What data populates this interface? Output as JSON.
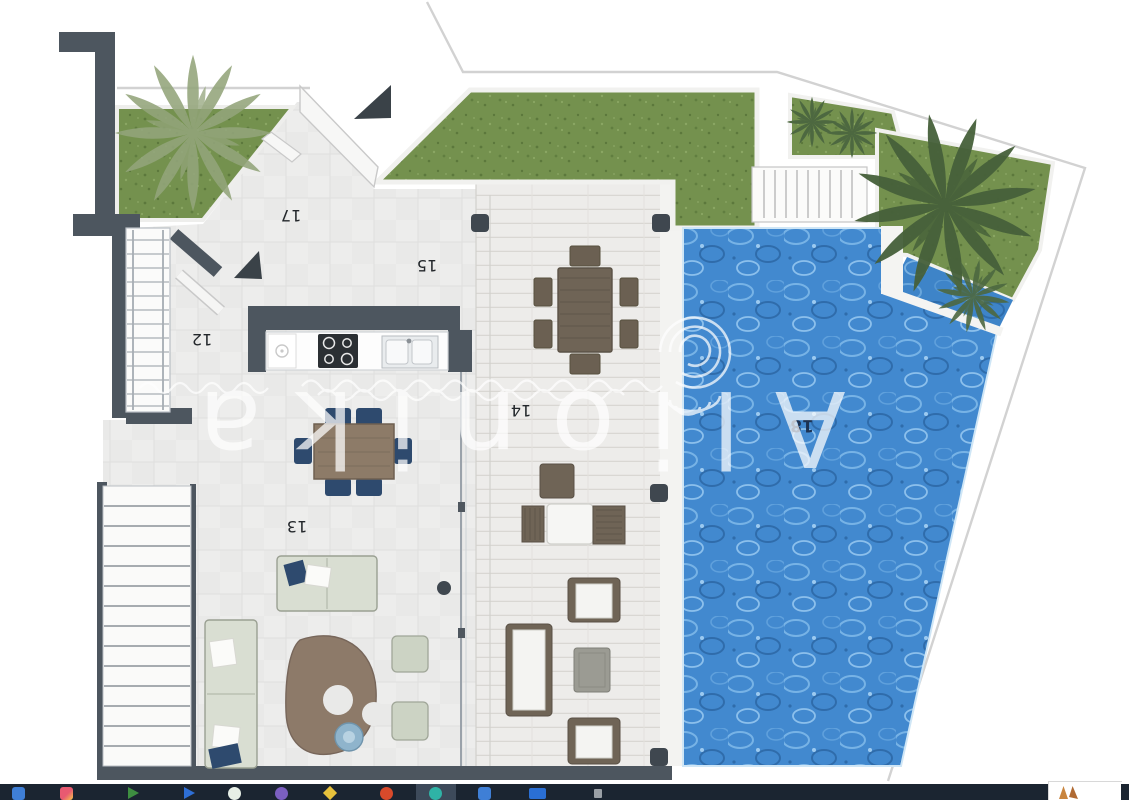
{
  "plan": {
    "labels": [
      {
        "text": "12"
      },
      {
        "text": "13"
      },
      {
        "text": "14"
      },
      {
        "text": "15"
      },
      {
        "text": "17"
      },
      {
        "text": "18"
      }
    ],
    "label_color": "#23272b",
    "pool_label_color": "#1c3354",
    "wall_color": "#4d565f",
    "grass_color": "#74914e",
    "water_color": "#4289cf"
  },
  "watermark": {
    "text": "Alionika",
    "color": "#ffffff"
  },
  "taskbar": {
    "background": "#1b2531",
    "active_highlight": "#3d4a5a",
    "icons": [
      {
        "name": "file-explorer",
        "color": "#3f7fd6",
        "shape": "rounded"
      },
      {
        "name": "photos-app",
        "color": "#e85a71",
        "color2": "#f6c94a",
        "shape": "rounded"
      },
      {
        "name": "green-play-app",
        "color": "#3e8e41",
        "shape": "triangle"
      },
      {
        "name": "blue-arrow-app",
        "color": "#2e6fd6",
        "shape": "triangle"
      },
      {
        "name": "light-circle-app",
        "color": "#e6efe6",
        "shape": "circle"
      },
      {
        "name": "purple-circle-app",
        "color": "#7b5fc0",
        "shape": "circle"
      },
      {
        "name": "yellow-app",
        "color": "#e7c23c",
        "shape": "diamond"
      },
      {
        "name": "red-flame-app",
        "color": "#d84a2b",
        "shape": "circle"
      },
      {
        "name": "teal-circle-app",
        "color": "#2fb3a6",
        "shape": "circle",
        "active": true
      },
      {
        "name": "blue-rounded-app",
        "color": "#3f7fd6",
        "shape": "rounded"
      },
      {
        "name": "blue-rect-app",
        "color": "#2a6fd4",
        "shape": "rect"
      },
      {
        "name": "gray-app",
        "color": "#9aa0a6",
        "shape": "rect-small"
      }
    ],
    "tray": {
      "background": "#ffffff",
      "glyph_colors": [
        "#c9853e",
        "#b06a33"
      ]
    }
  }
}
